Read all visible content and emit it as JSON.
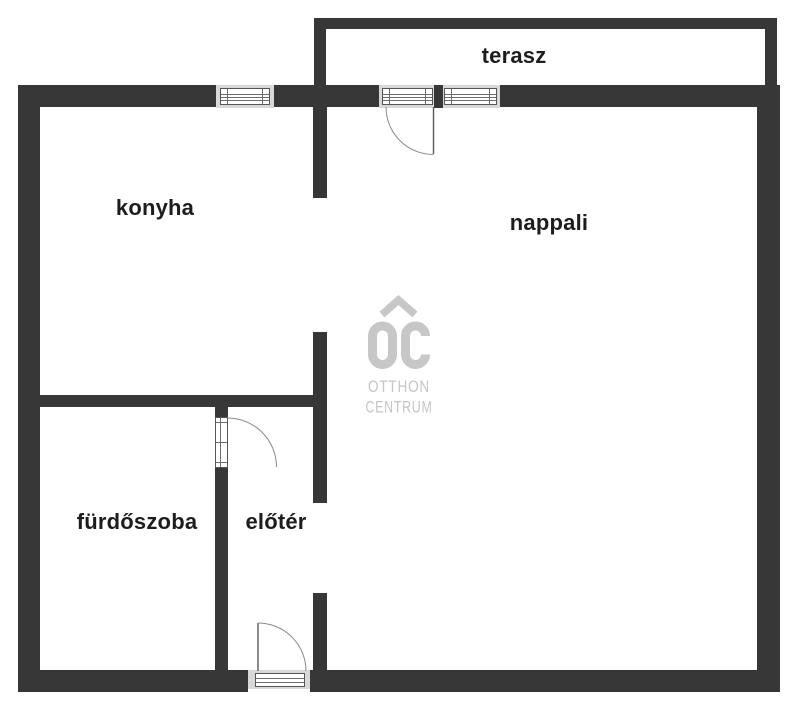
{
  "floorplan": {
    "rooms": [
      {
        "id": "terasz",
        "label": "terasz"
      },
      {
        "id": "konyha",
        "label": "konyha"
      },
      {
        "id": "nappali",
        "label": "nappali"
      },
      {
        "id": "furdoszoba",
        "label": "fürdőszoba"
      },
      {
        "id": "eloter",
        "label": "előtér"
      }
    ],
    "watermark": {
      "monogram": "OC",
      "line1": "OTTHON",
      "line2": "CENTRUM"
    },
    "colors": {
      "background": "#ffffff",
      "wall": "#373737",
      "label_text": "#1d1d1d",
      "window_sill": "#d8d8d8",
      "fixture_line": "#8a8a8a",
      "watermark_gray": "#c5c5c5"
    }
  }
}
